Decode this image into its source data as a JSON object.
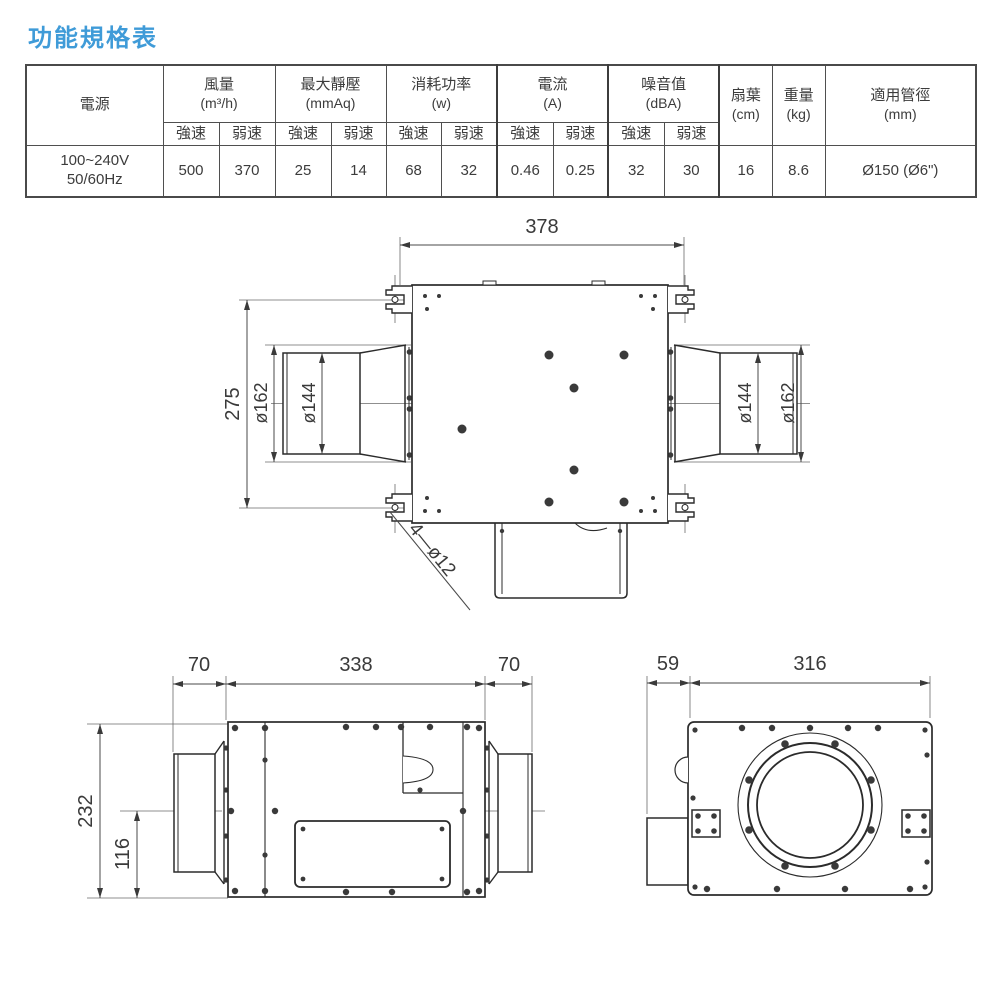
{
  "title": "功能規格表",
  "colors": {
    "title_accent": "#3F9BD8",
    "drawing_line": "#2b2b2b",
    "dim_text": "#3a3a3a"
  },
  "table": {
    "power_header": "電源",
    "speed_high": "強速",
    "speed_low": "弱速",
    "groups": [
      {
        "label": "風量",
        "unit": "(m³/h)"
      },
      {
        "label": "最大靜壓",
        "unit": "(mmAq)"
      },
      {
        "label": "消耗功率",
        "unit": "(w)"
      },
      {
        "label": "電流",
        "unit": "(A)"
      },
      {
        "label": "噪音值",
        "unit": "(dBA)"
      }
    ],
    "singles": [
      {
        "label": "扇葉",
        "unit": "(cm)"
      },
      {
        "label": "重量",
        "unit": "(kg)"
      },
      {
        "label": "適用管徑",
        "unit": "(mm)"
      }
    ],
    "row": {
      "power_line1": "100~240V",
      "power_line2": "50/60Hz",
      "values": [
        "500",
        "370",
        "25",
        "14",
        "68",
        "32",
        "0.46",
        "0.25",
        "32",
        "30"
      ],
      "fan": "16",
      "weight": "8.6",
      "duct": "Ø150 (Ø6\")"
    }
  },
  "drawings": {
    "top_view": {
      "width": "378",
      "height": "275",
      "left_outer": "ø162",
      "left_inner": "ø144",
      "right_inner": "ø144",
      "right_outer": "ø162",
      "holes": "4—ø12"
    },
    "side_view": {
      "left_collar": "70",
      "body": "338",
      "right_collar": "70",
      "height": "232",
      "half_height": "116"
    },
    "front_view": {
      "offset": "59",
      "width": "316"
    }
  }
}
